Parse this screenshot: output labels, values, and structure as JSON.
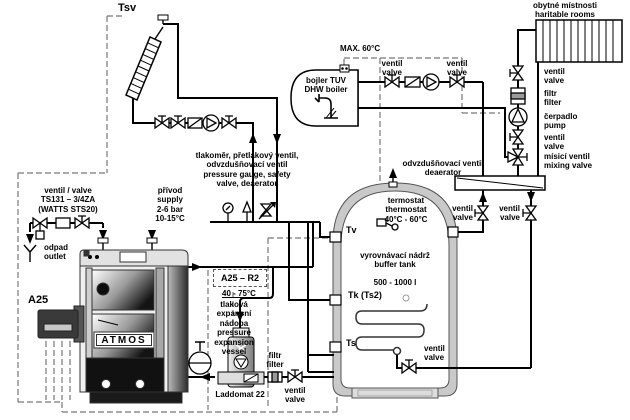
{
  "solar": {
    "sensor": "Tsv"
  },
  "rooms": {
    "cz": "obytné místnosti",
    "en": "haritable rooms"
  },
  "radiator_circuit": {
    "valve1_cz": "ventil",
    "valve1_en": "valve",
    "filter_cz": "filtr",
    "filter_en": "filter",
    "pump_cz": "čerpadlo",
    "pump_en": "pump",
    "valve2_cz": "ventil",
    "valve2_en": "valve",
    "mix_cz": "mísicí ventil",
    "mix_en": "mixing valve"
  },
  "dhw": {
    "max_temp": "MAX. 60°C",
    "name_cz": "bojler TUV",
    "name_en": "DHW boiler",
    "valve1_cz": "ventil",
    "valve1_en": "valve",
    "valve2_cz": "ventil",
    "valve2_en": "valve"
  },
  "safety_group": {
    "line1": "tlakoměr, přetlakový ventil,",
    "line2": "odvzdušňovací ventil",
    "line3": "pressure gauge, safety",
    "line4": "valve, deaerator"
  },
  "deaerator": {
    "cz": "odvzdušňovací ventil",
    "en": "deaerator"
  },
  "thermostat": {
    "cz": "termostat",
    "en": "thermostat",
    "range": "40°C - 60°C"
  },
  "tank": {
    "name_cz": "vyrovnávací nádrž",
    "name_en": "buffer tank",
    "volume": "500 - 1000 l",
    "sensor_top": "Tv",
    "sensor_mid": "Tk (Ts2)",
    "sensor_bottom": "Ts",
    "valve_cz": "ventil",
    "valve_en": "valve",
    "left_valve_cz": "ventil",
    "left_valve_en": "valve",
    "right_valve_cz": "ventil",
    "right_valve_en": "valve"
  },
  "supply": {
    "cz": "přívod",
    "en": "supply",
    "pressure": "2-6 bar",
    "temp": "10-15°C"
  },
  "fill_valve": {
    "line1": "ventil / valve",
    "line2": "TS131 – 3/4ZA",
    "line3": "(WATTS STS20)"
  },
  "drain": {
    "cz": "odpad",
    "en": "outlet"
  },
  "boiler": {
    "model": "A25",
    "brand": "ATMOS",
    "circuit": "A25 – R2",
    "temp_range": "40 - 75°C"
  },
  "expansion_vessel": {
    "l1": "tlaková",
    "l2": "expansní",
    "l3": "nádoba",
    "l4": "pressure",
    "l5": "expansion",
    "l6": "vessel"
  },
  "laddomat": {
    "label": "Laddomat 22",
    "filter_cz": "filtr",
    "filter_en": "filter",
    "valve_cz": "ventil",
    "valve_en": "valve"
  }
}
